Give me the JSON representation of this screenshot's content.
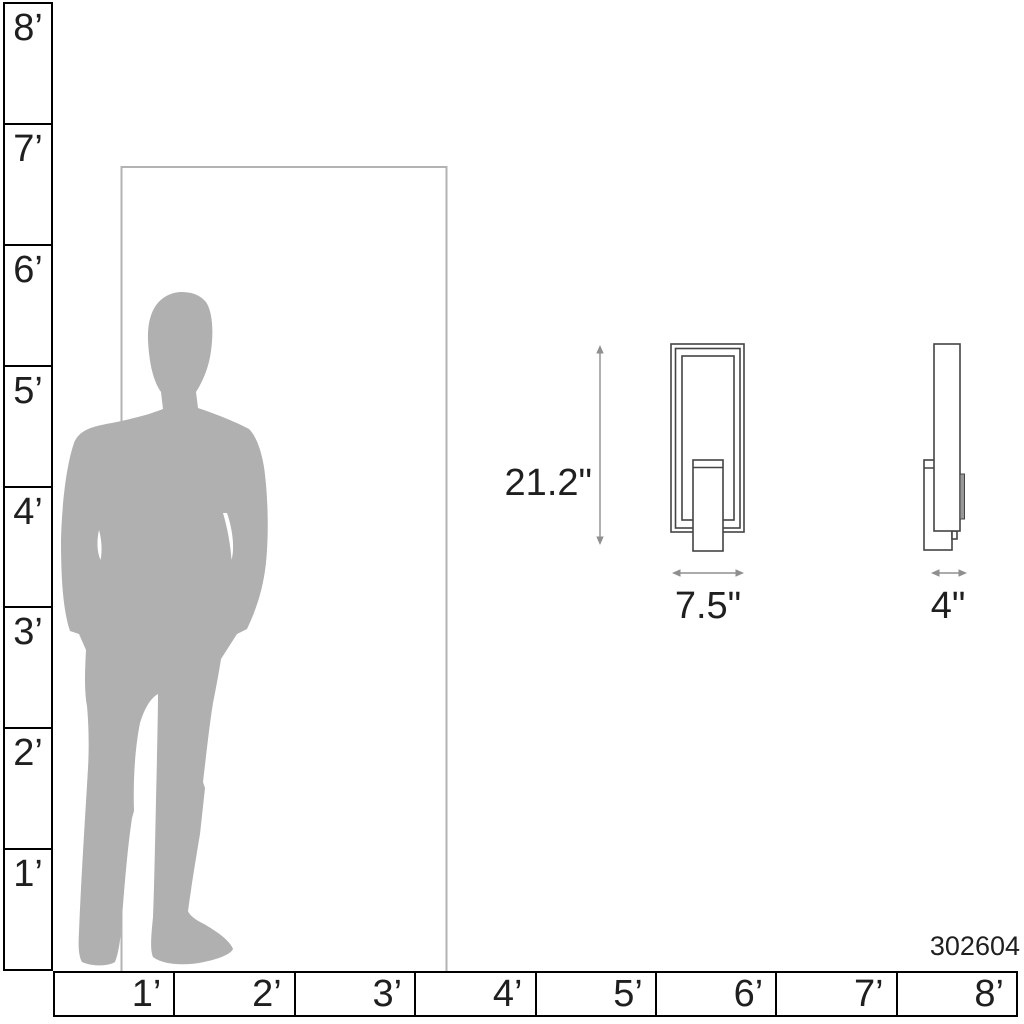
{
  "diagram": {
    "product_code": "302604",
    "dimensions": {
      "height": "21.2\"",
      "width": "7.5\"",
      "depth": "4\""
    }
  },
  "rulers": {
    "vertical": {
      "labels": [
        "8’",
        "7’",
        "6’",
        "5’",
        "4’",
        "3’",
        "2’",
        "1’"
      ]
    },
    "horizontal": {
      "labels": [
        "1’",
        "2’",
        "3’",
        "4’",
        "5’",
        "6’",
        "7’",
        "8’"
      ]
    }
  },
  "figures": {
    "person": "man-silhouette",
    "door": "door-outline",
    "front_view": "wall-sconce-front-view",
    "side_view": "wall-sconce-side-view"
  },
  "colors": {
    "silhouette": "#b0b0b0",
    "door_line": "#b3b3b3",
    "drawing_line": "#444444",
    "arrow": "#8f8f8f",
    "ruler_line": "#000000",
    "text": "#1f1f1f",
    "background": "#ffffff"
  }
}
